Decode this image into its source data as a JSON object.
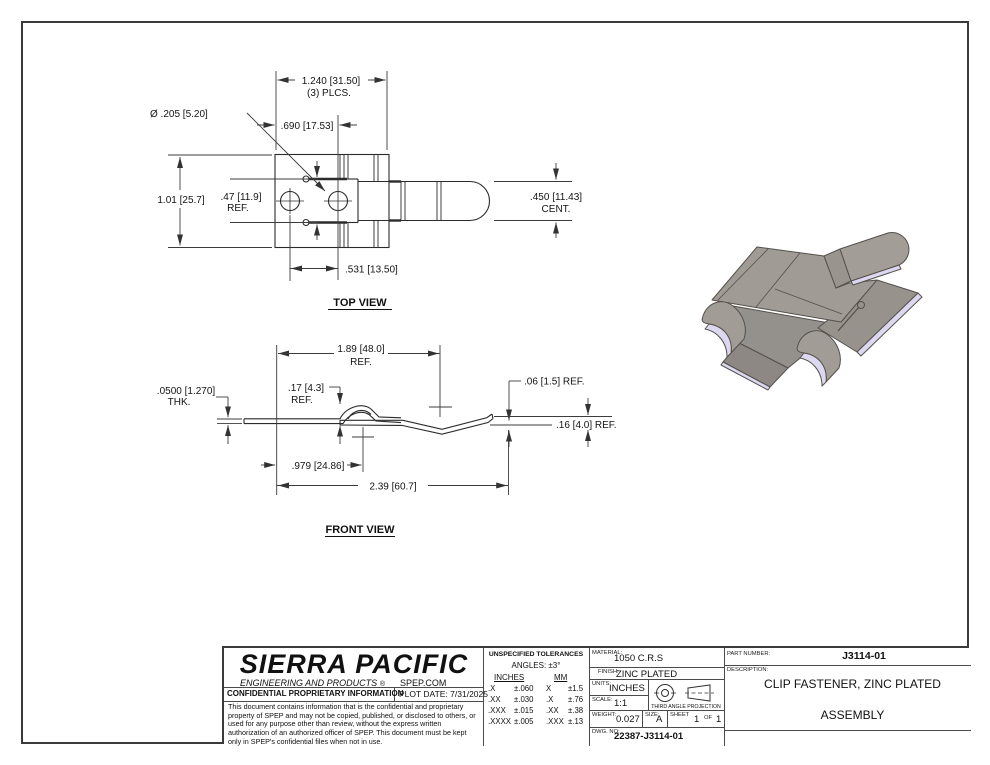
{
  "top_view": {
    "title": "TOP VIEW",
    "dims": {
      "overall": "1.240 [31.50]",
      "overall_note": "(3) PLCS.",
      "hole_dia": "Ø .205 [5.20]",
      "hole_offset": ".690 [17.53]",
      "height": "1.01 [25.7]",
      "slot_height": ".47 [11.9]",
      "slot_height_ref": "REF.",
      "tongue_width": ".450 [11.43]",
      "tongue_width_note": "CENT.",
      "hole_spacing": ".531 [13.50]"
    }
  },
  "front_view": {
    "title": "FRONT VIEW",
    "dims": {
      "body_length": "1.89 [48.0]",
      "body_length_ref": "REF.",
      "thickness": ".0500 [1.270]",
      "thickness_note": "THK.",
      "arch_height": ".17 [4.3]",
      "arch_height_ref": "REF.",
      "tip_rise": ".06 [1.5] REF.",
      "end_height": ".16 [4.0] REF.",
      "arch_center": ".979 [24.86]",
      "overall_length": "2.39 [60.7]"
    }
  },
  "iso_view": {
    "face_color": "#a19b96",
    "base_color": "#98928d",
    "dark_color": "#8d8883",
    "edge_color": "#dbd8f0",
    "outline_color": "#55504b"
  },
  "title_block": {
    "company": "SIERRA PACIFIC",
    "tagline": "ENGINEERING AND PRODUCTS",
    "reg_mark": "®",
    "website": "SPEP.COM",
    "confidential_header": "CONFIDENTIAL PROPRIETARY INFORMATION",
    "plot_date": "PLOT DATE: 7/31/2025",
    "disclaimer": "This document contains information that is the confidential and proprietary property of SPEP and may not be copied, published, or disclosed to others, or used for any purpose other than review, without the express written authorization of an authorized officer of SPEP. This document must be kept only in SPEP's confidential files when not in use.",
    "tolerances": {
      "header": "UNSPECIFIED TOLERANCES",
      "angles": "ANGLES: ±3°",
      "col_inches": "INCHES",
      "col_mm": "MM",
      "rows": [
        [
          ".X",
          "±.060",
          "X",
          "±1.5"
        ],
        [
          ".XX",
          "±.030",
          ".X",
          "±.76"
        ],
        [
          ".XXX",
          "±.015",
          ".XX",
          "±.38"
        ],
        [
          ".XXXX",
          "±.005",
          ".XXX",
          "±.13"
        ]
      ]
    },
    "material_label": "MATERIAL:",
    "material": "1050 C.R.S",
    "finish_label": "FINISH:",
    "finish": "ZINC PLATED",
    "units_label": "UNITS:",
    "units": "INCHES",
    "scale_label": "SCALE:",
    "scale": "1:1",
    "projection": "THIRD ANGLE PROJECTION",
    "weight_label": "WEIGHT:",
    "weight": "0.027",
    "size_label": "SIZE:",
    "size": "A",
    "sheet_label": "SHEET",
    "sheet_num": "1",
    "of_label": "OF",
    "sheet_total": "1",
    "dwg_label": "DWG. NO:",
    "dwg_no": "22387-J3114-01",
    "part_number_label": "PART NUMBER:",
    "part_number": "J3114-01",
    "description_label": "DESCRIPTION:",
    "description_line1": "CLIP FASTENER, ZINC PLATED",
    "description_line2": "ASSEMBLY"
  }
}
